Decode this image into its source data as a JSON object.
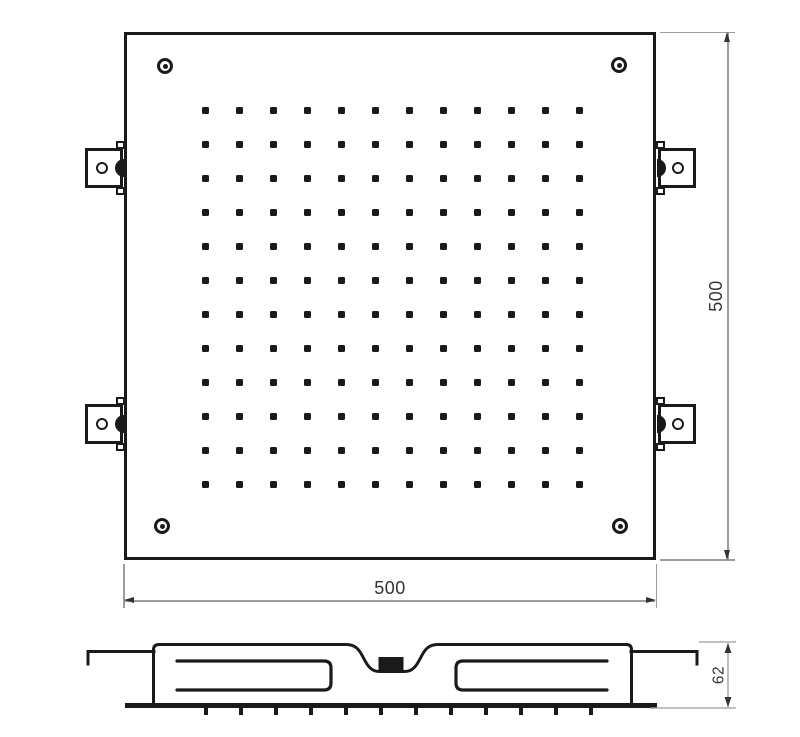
{
  "drawing": {
    "description": "shower-head-technical-drawing",
    "dimensions": {
      "width": {
        "label": "500"
      },
      "height": {
        "label": "500"
      },
      "depth": {
        "label": "62"
      }
    },
    "colors": {
      "line": "#1a1a1a",
      "dim_line": "#9c9c9c",
      "dim_text": "#333333",
      "background": "#ffffff"
    },
    "nozzle_grid": {
      "rows": 12,
      "cols": 12,
      "x0": 202,
      "y0": 107,
      "dx": 34,
      "dy": 34,
      "size": 7
    },
    "side_nozzle_ticks": {
      "count": 12,
      "x0": 206,
      "dx": 35,
      "y": 708,
      "len": 7
    },
    "screws": [
      {
        "x": 165,
        "y": 66
      },
      {
        "x": 619,
        "y": 65
      },
      {
        "x": 162,
        "y": 526
      },
      {
        "x": 620,
        "y": 526
      }
    ],
    "brackets": [
      {
        "side": "left",
        "cy": 168
      },
      {
        "side": "left",
        "cy": 424
      },
      {
        "side": "right",
        "cy": 168
      },
      {
        "side": "right",
        "cy": 424
      }
    ]
  }
}
